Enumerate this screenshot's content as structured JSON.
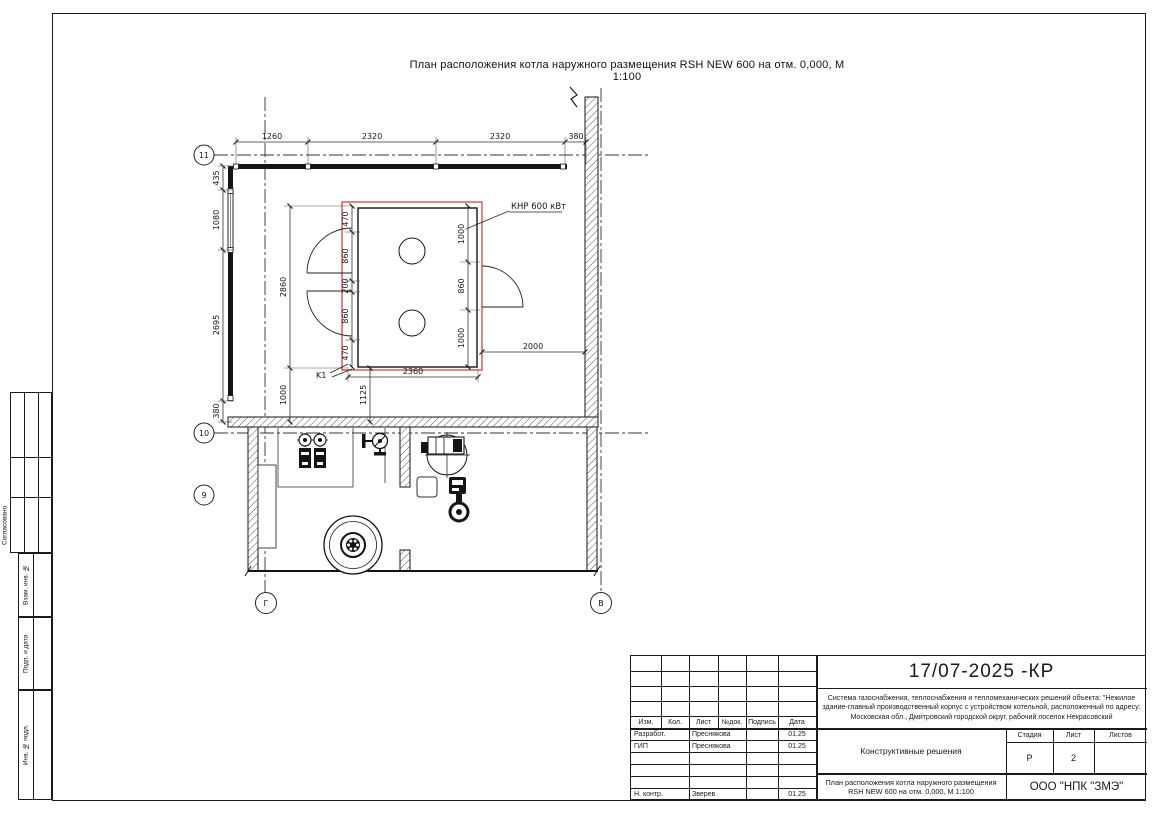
{
  "drawing_title": "План расположения котла наружного размещения RSH NEW 600 на отм. 0,000,  М 1:100",
  "plan": {
    "labels": {
      "boiler": "КНР 600 кВт",
      "k1": "K1"
    },
    "axes": {
      "row1": "11",
      "row2": "10",
      "row3": "9",
      "colG": "Г",
      "colV": "В"
    },
    "dims": {
      "top": [
        "1260",
        "2320",
        "2320",
        "380"
      ],
      "left": [
        "435",
        "1080",
        "2695",
        "380"
      ],
      "boiler_total": "2860",
      "boiler_offset": "1000",
      "chain_left": [
        "470",
        "860",
        "200",
        "860",
        "470"
      ],
      "chain_right": [
        "1000",
        "860",
        "1000"
      ],
      "boiler_width": "2360",
      "offset_1125": "1125",
      "to_wall": "2000"
    },
    "colors": {
      "boiler_outline": "#cf4545",
      "line": "#1a1a1a"
    }
  },
  "side_strip": {
    "approved": "Согласовано",
    "vzam": "Взам. инв. №",
    "podp": "Подп. и дата",
    "inv": "Инв. № подл."
  },
  "title_block": {
    "doc_number": "17/07-2025 -КР",
    "project": "Система газоснабжения, теплоснабжения и тепломеханических решений объекта: \"Нежилое здание-главный производственный корпус с устройством котельной, расположенный по адресу: Московская обл., Дмитровский городской округ, рабочий поселок Некрасовский",
    "section": "Конструктивные решения",
    "sheet_title": "План расположения котла наружного размещения RSH NEW 600 на отм. 0,000,  М 1:100",
    "company": "ООО \"НПК \"ЗМЭ\"",
    "headers": {
      "izm": "Изм.",
      "kol": "Кол.",
      "list": "Лист",
      "ndok": "№док.",
      "podpis": "Подпись",
      "data": "Дата"
    },
    "stage": {
      "stadia_label": "Стадия",
      "list_label": "Лист",
      "listov_label": "Листов",
      "stadia": "Р",
      "list": "2",
      "listov": ""
    },
    "rows": [
      {
        "role": "Разработ.",
        "name": "Преснякова",
        "date": "01.25"
      },
      {
        "role": "ГИП",
        "name": "Преснякова",
        "date": "01.25"
      },
      {
        "role": "",
        "name": "",
        "date": ""
      },
      {
        "role": "",
        "name": "",
        "date": ""
      },
      {
        "role": "",
        "name": "",
        "date": ""
      },
      {
        "role": "Н. контр.",
        "name": "Зверев",
        "date": "01.25"
      }
    ]
  }
}
